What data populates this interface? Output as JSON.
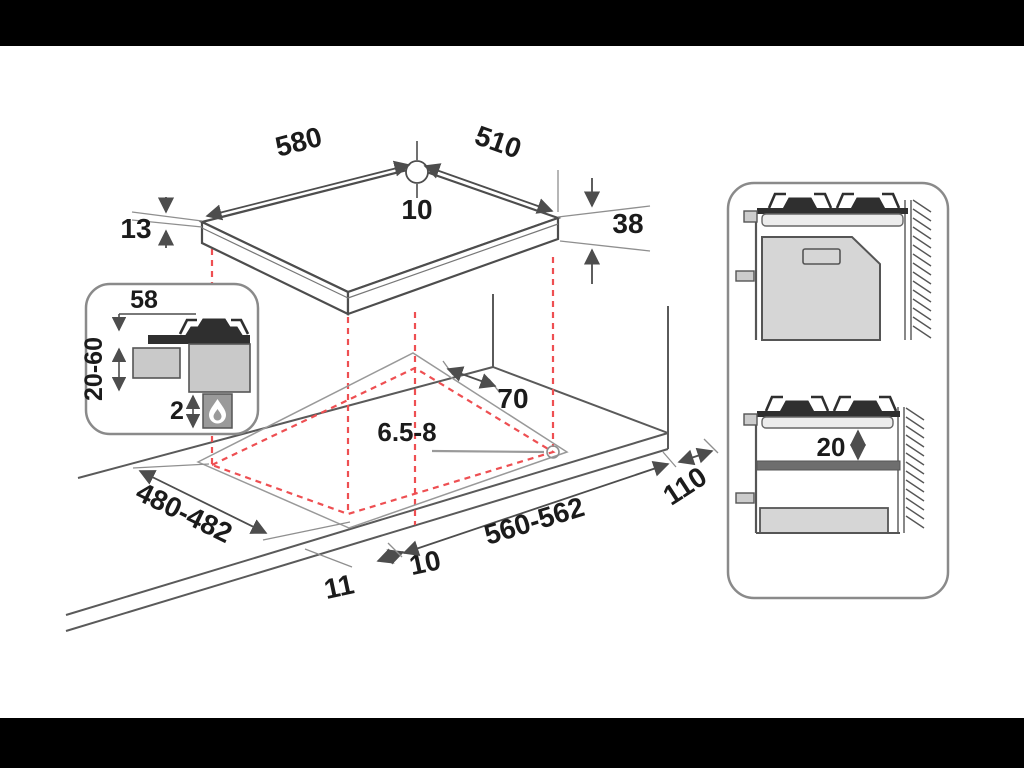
{
  "diagram": {
    "type": "appliance-installation-drawing",
    "subject": "built-in gas hob cutout and clearance dimensions"
  },
  "colors": {
    "letterbox": "#000000",
    "background": "#ffffff",
    "line": "#4d4d4d",
    "thin_line": "#8f8f8f",
    "red_dashed": "#ee4f52",
    "fill_light": "#d6d6d6",
    "fill_mid": "#9a9a9a",
    "fill_dark": "#2f2f2f",
    "text": "#1b1b1b"
  },
  "labels": {
    "hob_width": "580",
    "hob_depth": "510",
    "hole_top": "10",
    "glass_thickness": "13",
    "hob_height": "38",
    "inset_top": "58",
    "inset_range": "20-60",
    "inset_gap": "2",
    "rear_clearance": "70",
    "screw_hole": "6.5-8",
    "cutout_depth": "480-482",
    "cutout_width": "560-562",
    "side_clearance": "110",
    "front_offset": "10",
    "front_edge": "11",
    "shelf_clearance": "20"
  },
  "icons": {
    "flame_drop": "flame-drop-icon",
    "burner": "burner-icon",
    "wall_hatch": "wall-hatch-pattern"
  }
}
